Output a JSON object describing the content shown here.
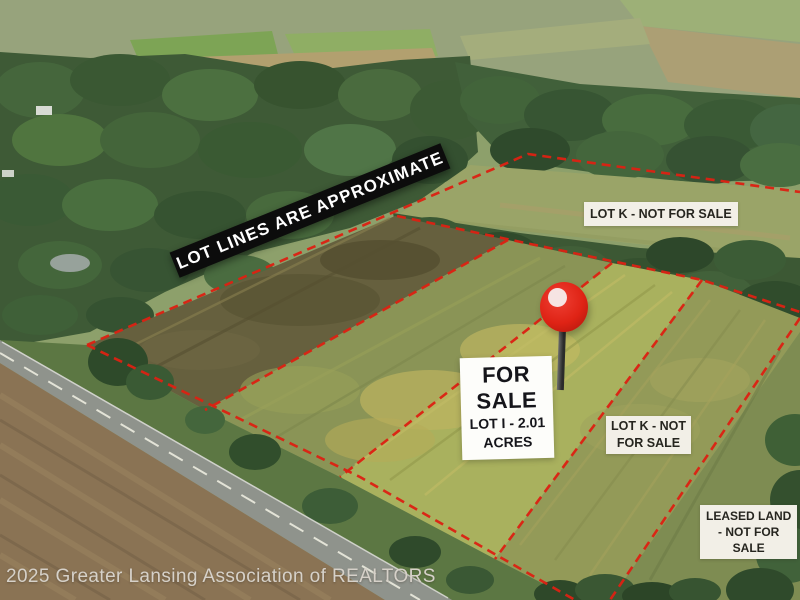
{
  "colors": {
    "lot_line_red": "#dc2113",
    "banner_bg": "#0c0c0c",
    "banner_text": "#ffffff",
    "label_bg": "#f2efe7",
    "label_text": "#26251f",
    "sign_bg": "#fdfdfa",
    "pin_red": "#df2315",
    "credit_text": "#d6d1c9"
  },
  "icons": {
    "map_pin": "red-map-pin"
  },
  "banner": {
    "text": "LOT LINES ARE APPROXIMATE"
  },
  "labels": {
    "lot_k_top": {
      "text": "LOT K - NOT FOR SALE"
    },
    "for_sale_sign": {
      "line1": "FOR",
      "line2": "SALE",
      "line3": "LOT I - 2.01",
      "line4": "ACRES"
    },
    "lot_k_right": {
      "line1": "LOT K - NOT",
      "line2": "FOR SALE"
    },
    "leased_land": {
      "line1": "LEASED LAND",
      "line2": "- NOT FOR",
      "line3": "SALE"
    }
  },
  "credit": {
    "text": "2025 Greater Lansing Association of REALTORS"
  }
}
